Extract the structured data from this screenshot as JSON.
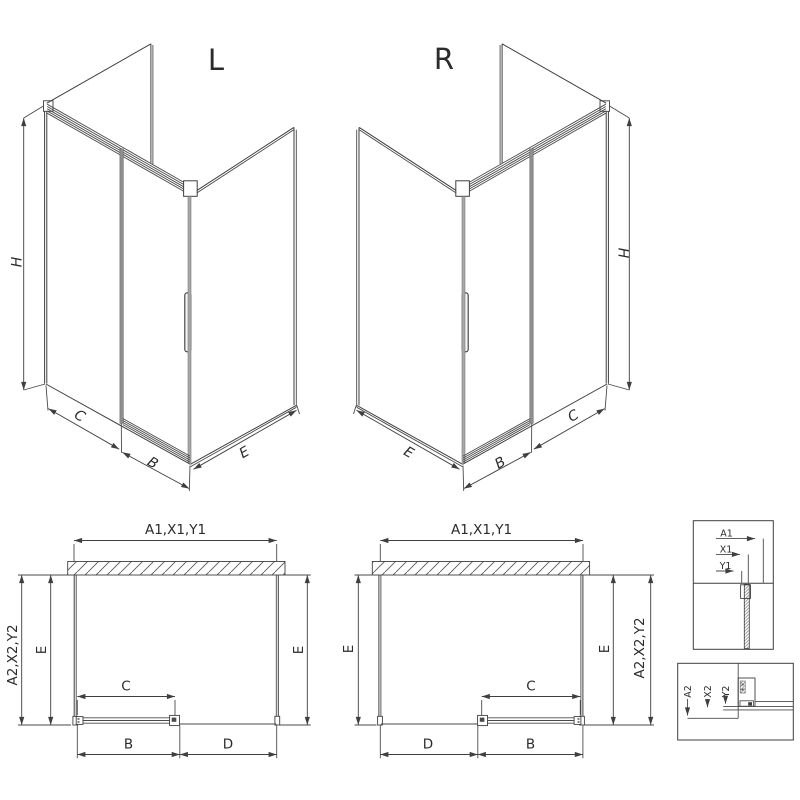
{
  "drawing": {
    "iso_left": {
      "title": "L",
      "h": "H",
      "c": "C",
      "b": "B",
      "e": "E"
    },
    "iso_right": {
      "title": "R",
      "h": "H",
      "c": "C",
      "b": "B",
      "e": "E"
    },
    "plan_left": {
      "top": "A1,X1,Y1",
      "outer": "A2,X2,Y2",
      "e_left": "E",
      "e_right": "E",
      "c": "C",
      "b": "B",
      "d": "D"
    },
    "plan_right": {
      "top": "A1,X1,Y1",
      "outer": "A2,X2,Y2",
      "e_left": "E",
      "e_right": "E",
      "c": "C",
      "b": "B",
      "d": "D"
    },
    "detail_top": {
      "a1": "A1",
      "x1": "X1",
      "y1": "Y1"
    },
    "detail_bottom": {
      "a2": "A2",
      "x2": "X2",
      "y2": "Y2"
    },
    "colors": {
      "line": "#3f3f3f",
      "door_gray": "#8f8f8f",
      "profile_gray": "#a8a8a8"
    }
  }
}
